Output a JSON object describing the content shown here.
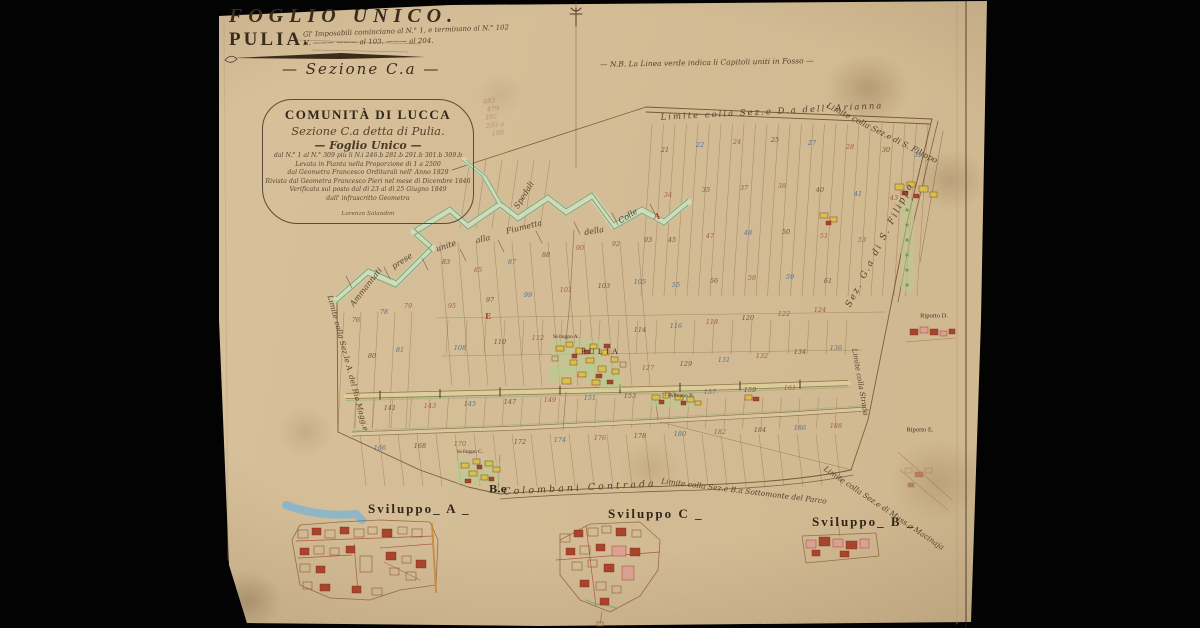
{
  "title_block": {
    "foglio": "FOGLIO UNICO.",
    "comune": "PULIA.",
    "annotation_line1": "Gl' Imposabili cominciano al N.° 1, e terminano al N.° 102",
    "annotation_line2": "N. ——— ——— al 103. ——— al 204.",
    "sezione": "— Sezione C.a —",
    "nota_verde": "— N.B. La Linea verde indica li Capitoli uniti in Fosso —"
  },
  "cartouche": {
    "line1": "COMUNITÀ DI LUCCA",
    "line2": "Sezione C.a detta di Pulia.",
    "line3": "— Foglio Unico —",
    "line4": "dal N.° 1 al N.° 309 più li N.i 246.b 281.b 291.b 301.b 309.b",
    "line5": "Levata in Pianta nella Proporzione di 1 a 2500",
    "line6": "dal Geometra Francesco Orditurali nell' Anno 1829",
    "line7": "Rivista dal Geometra Francesco Pieri nel mese di Dicembre 1846",
    "line8": "Verificata sul posto dal dì 23 al dì 25 Giugno 1849",
    "line9": "dall' infrascritto Geometra",
    "signature": "Lorenzo Salandini"
  },
  "sviluppi": {
    "a": "Sviluppo_ A _",
    "c": "Sviluppo C _",
    "b": "Sviluppo_ B _"
  },
  "map_labels": [
    {
      "t": "Limite colla Sez.e D.a dell' Arianna",
      "x": 772,
      "y": 112,
      "r": -3,
      "s": 8.5,
      "ls": 2
    },
    {
      "t": "Limite colla Sez.e di S. Filippo",
      "x": 882,
      "y": 133,
      "r": 27,
      "s": 8
    },
    {
      "t": "Sez. G.a di S. Filippo",
      "x": 880,
      "y": 245,
      "r": -63,
      "s": 9,
      "ls": 2
    },
    {
      "t": "Limite colla Sez.le A. del Rio Magg.e",
      "x": 348,
      "y": 363,
      "r": 75,
      "s": 7.5
    },
    {
      "t": "Limite colla Sez.e di Mass.a Macinaja",
      "x": 884,
      "y": 508,
      "r": 34,
      "s": 7.5
    },
    {
      "t": "Limite colla Sez.e B.a Sottomonte del Parco",
      "x": 744,
      "y": 491,
      "r": 7,
      "s": 7.5
    },
    {
      "t": "Colombani Contrada",
      "x": 580,
      "y": 488,
      "r": -3,
      "s": 9.5,
      "ls": 3
    },
    {
      "t": "B.e",
      "x": 498,
      "y": 490,
      "r": 0,
      "s": 10,
      "k": "dark"
    },
    {
      "t": "Ammannati",
      "x": 366,
      "y": 287,
      "r": -52,
      "s": 8
    },
    {
      "t": "prese",
      "x": 402,
      "y": 261,
      "r": -33,
      "s": 8
    },
    {
      "t": "unite",
      "x": 446,
      "y": 246,
      "r": -18,
      "s": 8
    },
    {
      "t": "alla",
      "x": 483,
      "y": 239,
      "r": -12,
      "s": 8
    },
    {
      "t": "Fiumetta",
      "x": 524,
      "y": 227,
      "r": -14,
      "s": 8
    },
    {
      "t": "della",
      "x": 594,
      "y": 231,
      "r": -10,
      "s": 8
    },
    {
      "t": "Colle",
      "x": 628,
      "y": 216,
      "r": -32,
      "s": 8
    },
    {
      "t": "Spedali",
      "x": 524,
      "y": 195,
      "r": -58,
      "s": 8
    },
    {
      "t": "Limite colla Strada",
      "x": 860,
      "y": 382,
      "r": 80,
      "s": 7
    },
    {
      "t": "PULIA",
      "x": 601,
      "y": 351,
      "r": 0,
      "s": 8.5,
      "k": "print",
      "ls": 3
    },
    {
      "t": "Sviluppo A.",
      "x": 566,
      "y": 337,
      "r": 0,
      "s": 5.5,
      "k": "print"
    },
    {
      "t": "Sviluppo B.",
      "x": 681,
      "y": 396,
      "r": 0,
      "s": 5.5,
      "k": "print"
    },
    {
      "t": "Sviluppo C.",
      "x": 470,
      "y": 452,
      "r": 0,
      "s": 5.5,
      "k": "print"
    },
    {
      "t": "Riporto D.",
      "x": 934,
      "y": 316,
      "r": 0,
      "s": 6.5,
      "k": "print"
    },
    {
      "t": "Riporto E.",
      "x": 920,
      "y": 430,
      "r": 0,
      "s": 6.5,
      "k": "print"
    },
    {
      "t": "483",
      "x": 489,
      "y": 101,
      "r": -6,
      "s": 6.5,
      "k": "pencil"
    },
    {
      "t": "479",
      "x": 493,
      "y": 109,
      "r": -6,
      "s": 6.5,
      "k": "pencil"
    },
    {
      "t": "392",
      "x": 491,
      "y": 117,
      "r": -6,
      "s": 6.5,
      "k": "pencil"
    },
    {
      "t": "293 a",
      "x": 495,
      "y": 125,
      "r": -6,
      "s": 6.5,
      "k": "pencil"
    },
    {
      "t": "198",
      "x": 498,
      "y": 133,
      "r": -6,
      "s": 6.5,
      "k": "pencil"
    },
    {
      "t": "E",
      "x": 488,
      "y": 316,
      "r": 0,
      "s": 8,
      "k": "mark"
    },
    {
      "t": "A",
      "x": 657,
      "y": 216,
      "r": 0,
      "s": 8,
      "k": "mark"
    }
  ],
  "parcel_numbers": [
    {
      "v": "21",
      "x": 665,
      "y": 150,
      "c": "s"
    },
    {
      "v": "22",
      "x": 700,
      "y": 145,
      "c": "b"
    },
    {
      "v": "24",
      "x": 737,
      "y": 142,
      "c": "r"
    },
    {
      "v": "25",
      "x": 775,
      "y": 140,
      "c": "s"
    },
    {
      "v": "27",
      "x": 812,
      "y": 143,
      "c": "b"
    },
    {
      "v": "28",
      "x": 850,
      "y": 147,
      "c": "r"
    },
    {
      "v": "30",
      "x": 886,
      "y": 150,
      "c": "s"
    },
    {
      "v": "31",
      "x": 918,
      "y": 155,
      "c": "b"
    },
    {
      "v": "34",
      "x": 668,
      "y": 195,
      "c": "r"
    },
    {
      "v": "35",
      "x": 706,
      "y": 190,
      "c": "s"
    },
    {
      "v": "37",
      "x": 744,
      "y": 188,
      "c": "b"
    },
    {
      "v": "38",
      "x": 782,
      "y": 186,
      "c": "r"
    },
    {
      "v": "40",
      "x": 820,
      "y": 190,
      "c": "s"
    },
    {
      "v": "41",
      "x": 858,
      "y": 194,
      "c": "b"
    },
    {
      "v": "43",
      "x": 894,
      "y": 198,
      "c": "r"
    },
    {
      "v": "45",
      "x": 672,
      "y": 240,
      "c": "s"
    },
    {
      "v": "47",
      "x": 710,
      "y": 236,
      "c": "r"
    },
    {
      "v": "48",
      "x": 748,
      "y": 233,
      "c": "b"
    },
    {
      "v": "50",
      "x": 786,
      "y": 232,
      "c": "s"
    },
    {
      "v": "51",
      "x": 824,
      "y": 236,
      "c": "r"
    },
    {
      "v": "53",
      "x": 862,
      "y": 240,
      "c": "b"
    },
    {
      "v": "55",
      "x": 676,
      "y": 285,
      "c": "b"
    },
    {
      "v": "56",
      "x": 714,
      "y": 281,
      "c": "s"
    },
    {
      "v": "58",
      "x": 752,
      "y": 278,
      "c": "r"
    },
    {
      "v": "59",
      "x": 790,
      "y": 277,
      "c": "b"
    },
    {
      "v": "61",
      "x": 828,
      "y": 281,
      "c": "s"
    },
    {
      "v": "76",
      "x": 356,
      "y": 320,
      "c": "s"
    },
    {
      "v": "78",
      "x": 384,
      "y": 312,
      "c": "b"
    },
    {
      "v": "79",
      "x": 408,
      "y": 306,
      "c": "r"
    },
    {
      "v": "80",
      "x": 372,
      "y": 356,
      "c": "s"
    },
    {
      "v": "81",
      "x": 400,
      "y": 350,
      "c": "b"
    },
    {
      "v": "83",
      "x": 446,
      "y": 262,
      "c": "s"
    },
    {
      "v": "85",
      "x": 478,
      "y": 270,
      "c": "r"
    },
    {
      "v": "87",
      "x": 512,
      "y": 262,
      "c": "b"
    },
    {
      "v": "88",
      "x": 546,
      "y": 255,
      "c": "s"
    },
    {
      "v": "90",
      "x": 580,
      "y": 248,
      "c": "r"
    },
    {
      "v": "92",
      "x": 616,
      "y": 244,
      "c": "b"
    },
    {
      "v": "93",
      "x": 648,
      "y": 240,
      "c": "s"
    },
    {
      "v": "95",
      "x": 452,
      "y": 306,
      "c": "r"
    },
    {
      "v": "97",
      "x": 490,
      "y": 300,
      "c": "s"
    },
    {
      "v": "99",
      "x": 528,
      "y": 295,
      "c": "b"
    },
    {
      "v": "101",
      "x": 566,
      "y": 290,
      "c": "r"
    },
    {
      "v": "103",
      "x": 604,
      "y": 286,
      "c": "s"
    },
    {
      "v": "105",
      "x": 640,
      "y": 282,
      "c": "b"
    },
    {
      "v": "108",
      "x": 460,
      "y": 348,
      "c": "b"
    },
    {
      "v": "110",
      "x": 500,
      "y": 342,
      "c": "s"
    },
    {
      "v": "112",
      "x": 538,
      "y": 338,
      "c": "r"
    },
    {
      "v": "114",
      "x": 640,
      "y": 330,
      "c": "s"
    },
    {
      "v": "116",
      "x": 676,
      "y": 326,
      "c": "b"
    },
    {
      "v": "118",
      "x": 712,
      "y": 322,
      "c": "r"
    },
    {
      "v": "120",
      "x": 748,
      "y": 318,
      "c": "s"
    },
    {
      "v": "122",
      "x": 784,
      "y": 314,
      "c": "b"
    },
    {
      "v": "124",
      "x": 820,
      "y": 310,
      "c": "r"
    },
    {
      "v": "127",
      "x": 648,
      "y": 368,
      "c": "r"
    },
    {
      "v": "129",
      "x": 686,
      "y": 364,
      "c": "s"
    },
    {
      "v": "131",
      "x": 724,
      "y": 360,
      "c": "b"
    },
    {
      "v": "132",
      "x": 762,
      "y": 356,
      "c": "r"
    },
    {
      "v": "134",
      "x": 800,
      "y": 352,
      "c": "s"
    },
    {
      "v": "136",
      "x": 836,
      "y": 348,
      "c": "b"
    },
    {
      "v": "141",
      "x": 390,
      "y": 408,
      "c": "s"
    },
    {
      "v": "143",
      "x": 430,
      "y": 406,
      "c": "r"
    },
    {
      "v": "145",
      "x": 470,
      "y": 404,
      "c": "b"
    },
    {
      "v": "147",
      "x": 510,
      "y": 402,
      "c": "s"
    },
    {
      "v": "149",
      "x": 550,
      "y": 400,
      "c": "r"
    },
    {
      "v": "151",
      "x": 590,
      "y": 398,
      "c": "b"
    },
    {
      "v": "153",
      "x": 630,
      "y": 396,
      "c": "s"
    },
    {
      "v": "155",
      "x": 670,
      "y": 394,
      "c": "r"
    },
    {
      "v": "157",
      "x": 710,
      "y": 392,
      "c": "b"
    },
    {
      "v": "159",
      "x": 750,
      "y": 390,
      "c": "s"
    },
    {
      "v": "161",
      "x": 790,
      "y": 388,
      "c": "r"
    },
    {
      "v": "166",
      "x": 380,
      "y": 448,
      "c": "b"
    },
    {
      "v": "168",
      "x": 420,
      "y": 446,
      "c": "s"
    },
    {
      "v": "170",
      "x": 460,
      "y": 444,
      "c": "r"
    },
    {
      "v": "172",
      "x": 520,
      "y": 442,
      "c": "s"
    },
    {
      "v": "174",
      "x": 560,
      "y": 440,
      "c": "b"
    },
    {
      "v": "176",
      "x": 600,
      "y": 438,
      "c": "r"
    },
    {
      "v": "178",
      "x": 640,
      "y": 436,
      "c": "s"
    },
    {
      "v": "180",
      "x": 680,
      "y": 434,
      "c": "b"
    },
    {
      "v": "182",
      "x": 720,
      "y": 432,
      "c": "r"
    },
    {
      "v": "184",
      "x": 760,
      "y": 430,
      "c": "s"
    },
    {
      "v": "186",
      "x": 800,
      "y": 428,
      "c": "b"
    },
    {
      "v": "188",
      "x": 836,
      "y": 426,
      "c": "r"
    }
  ],
  "colors": {
    "paper": "#d6c09b",
    "ink": "#4a3826",
    "hand_ink": "#55422c",
    "red": "#a8432c",
    "pink": "#d9a094",
    "yellow": "#d9bf4e",
    "green": "#7fa577",
    "pale_green": "#cfe0c2",
    "water_blue": "#85b5cc",
    "number_sepia": "#6b4a33",
    "number_red": "#a5503b",
    "number_blue": "#49688f",
    "road_edge": "#8a6a40"
  }
}
